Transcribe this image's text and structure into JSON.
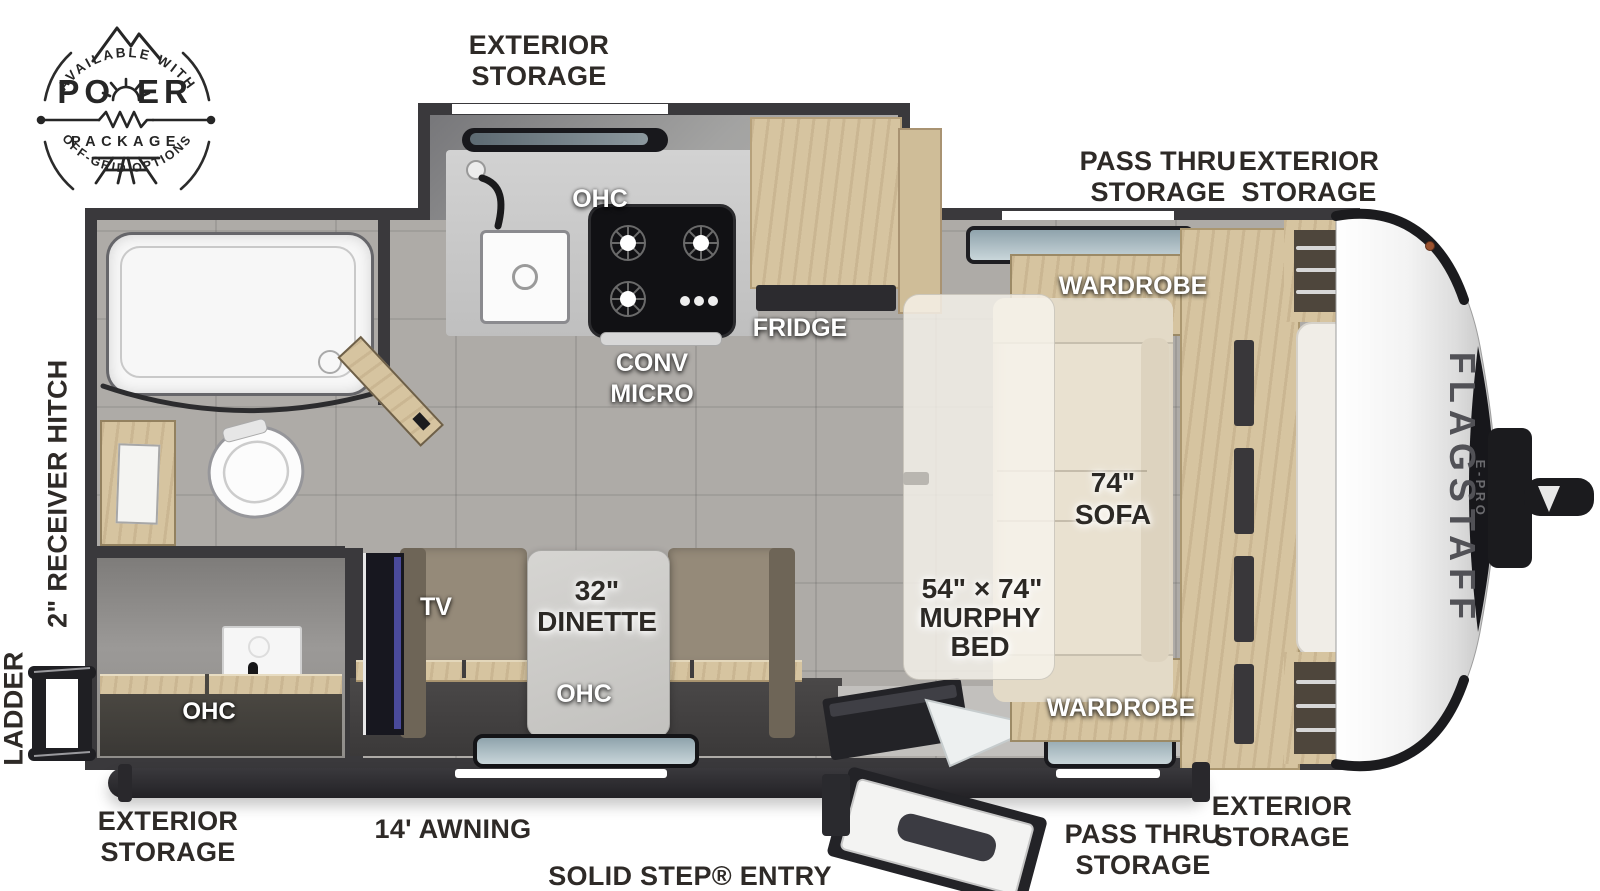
{
  "badge": {
    "arc_top": "AVAILABLE WITH",
    "power_left": "PO",
    "power_right": "ER",
    "package": "PACKAGE",
    "arc_bottom": "OFF-GRID OPTIONS"
  },
  "branding": {
    "model": "FLAGSTAFF",
    "series": "E-PRO"
  },
  "exterior": {
    "exterior_storage": "EXTERIOR STORAGE",
    "pass_thru_storage": "PASS THRU STORAGE",
    "receiver_hitch": "2\" RECEIVER HITCH",
    "ladder": "LADDER",
    "awning": "14' AWNING",
    "solid_step_entry": "SOLID STEP® ENTRY"
  },
  "interior": {
    "ohc": "OHC",
    "wardrobe": "WARDROBE",
    "fridge": "FRIDGE",
    "conv": "CONV",
    "micro": "MICRO",
    "tv": "TV",
    "dinette_size": "32\"",
    "dinette": "DINETTE",
    "sofa_size": "74\"",
    "sofa": "SOFA",
    "murphy_size": "54\" × 74\"",
    "murphy": "MURPHY",
    "bed": "BED"
  }
}
